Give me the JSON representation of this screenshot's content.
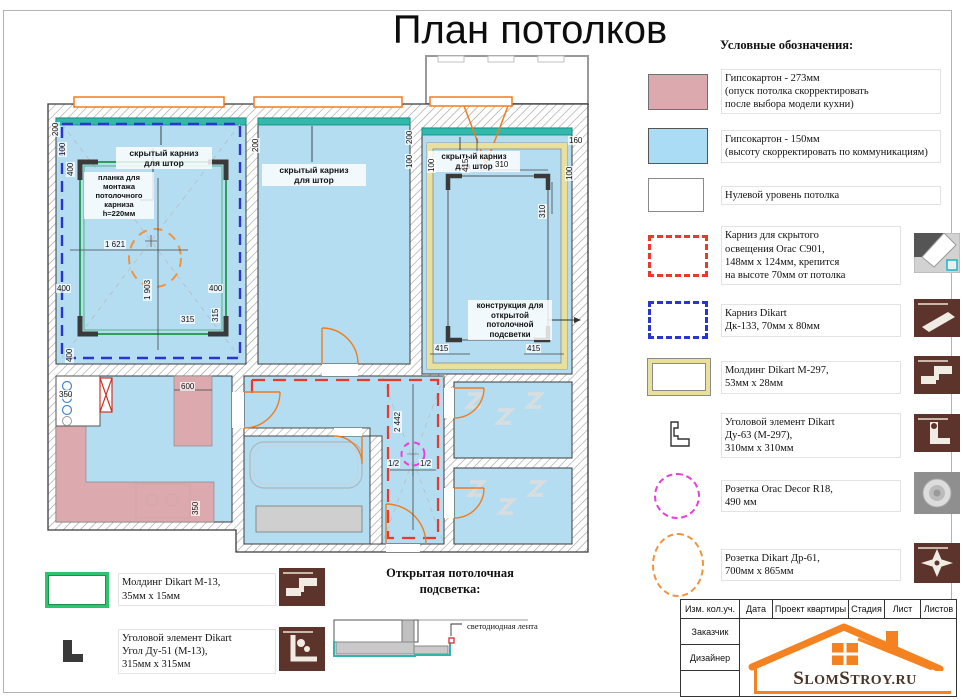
{
  "title": "План потолков",
  "legend": {
    "heading": "Условные обозначения:",
    "items": [
      {
        "text": "Гипсокартон - 273мм\n(опуск потолка скорректировать\nпосле выбора модели кухни)"
      },
      {
        "text": "Гипсокартон - 150мм\n(высоту скорректировать по коммуникациям)"
      },
      {
        "text": "Нулевой уровень потолка"
      },
      {
        "text": "Карниз для скрытого\nосвещения Orac C901,\n148мм х 124мм, крепится\nна высоте 70мм от потолка"
      },
      {
        "text": "Карниз Dikart\nДк-133, 70мм х 80мм"
      },
      {
        "text": "Молдинг Dikart М-297,\n53мм х 28мм"
      },
      {
        "text": "Уголовой элемент Dikart\nДу-63 (М-297),\n310мм х 310мм"
      },
      {
        "text": "Розетка Orac Decor R18,\n490 мм"
      },
      {
        "text": "Розетка Dikart Др-61,\n700мм х 865мм"
      }
    ]
  },
  "legend2": {
    "molding": "Молдинг Dikart М-13,\n35мм х 15мм",
    "corner": "Уголовой элемент Dikart\nУгол Ду-51 (М-13),\n315мм х 315мм"
  },
  "detail": {
    "heading": "Открытая потолочная\nподсветка:",
    "led_label": "светодиодная лента"
  },
  "plan": {
    "labels": {
      "curtain": "скрытый карниз\nдля штор",
      "plank": "планка для\nмонтажа\nпотолочного\nкарниза\nh=220мм",
      "openlight": "конструкция для\nоткрытой\nпотолочной\nподсветки"
    },
    "dims": {
      "d1621": "1 621",
      "d1903": "1 903",
      "d2442": "2 442",
      "d400": "400",
      "d315": "315",
      "d200": "200",
      "d100": "100",
      "d415": "415",
      "d310": "310",
      "d160": "160",
      "d600": "600",
      "d350": "350",
      "dhalf": "1/2"
    }
  },
  "table": {
    "headers": [
      "Изм. кол.уч.",
      "Дата",
      "Проект квартиры",
      "Стадия",
      "Лист",
      "Листов"
    ],
    "rows": [
      "Заказчик",
      "Дизайнер",
      ""
    ]
  },
  "logo": {
    "p1": "S",
    "p2": "LOM",
    "p3": "S",
    "p4": "TROY.RU"
  },
  "colors": {
    "room_blue": "#b5ddf2",
    "drop_pink": "#dcaaae",
    "cornice_teal": "#33b8ac",
    "red_dash": "#e8392a",
    "blue_dash": "#2a35cf",
    "green_molding": "#2e9e59",
    "yellow_molding": "#e9e09b",
    "rosette_magenta": "#ea3fd8",
    "rosette_orange": "#f0933f",
    "window_orange": "#ef7d20",
    "logo_orange": "#f58220",
    "logo_brown": "#4a3426"
  }
}
